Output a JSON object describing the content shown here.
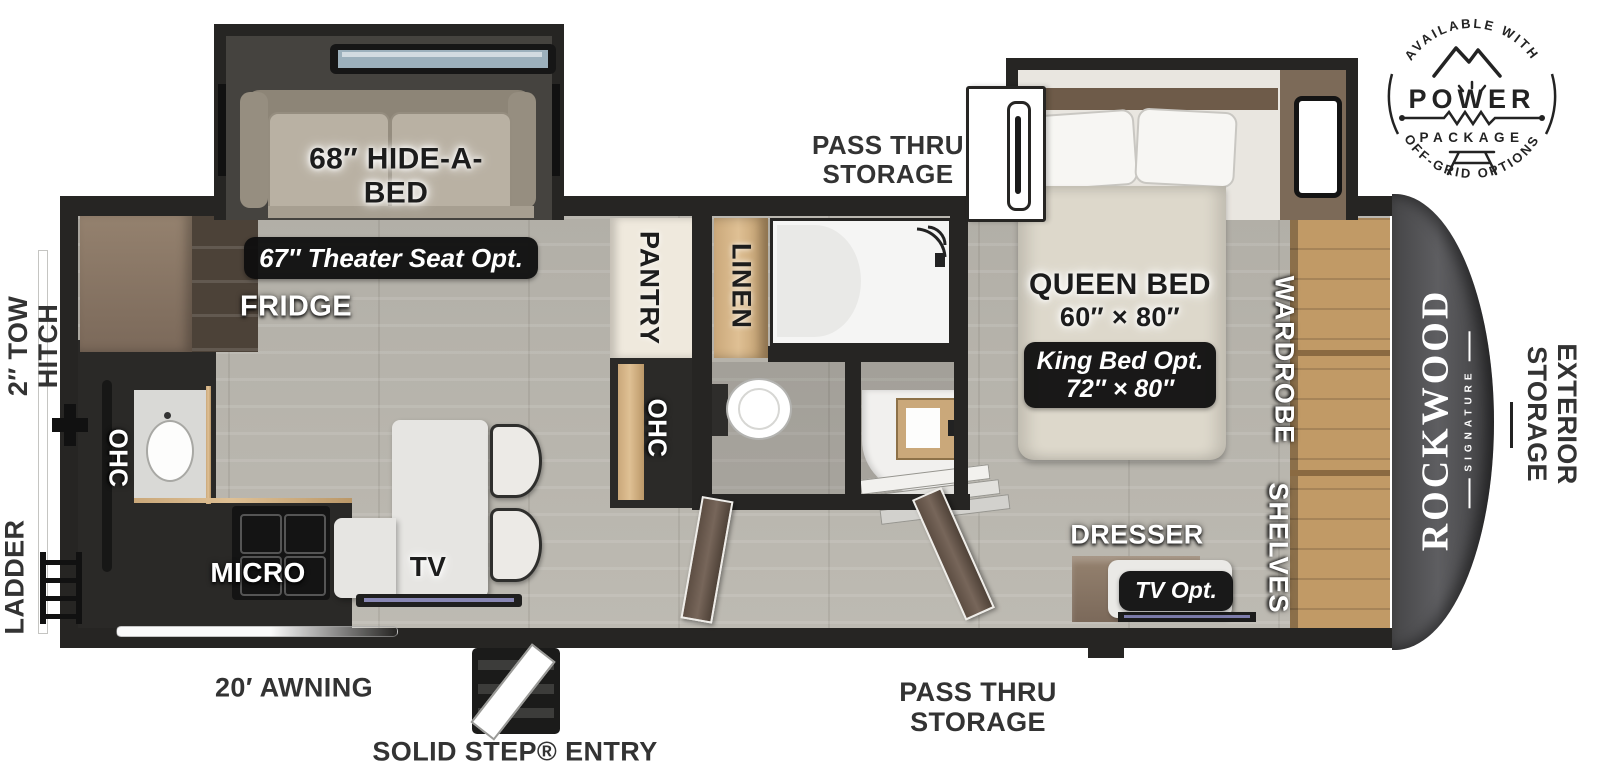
{
  "badge": {
    "arc_top": "AVAILABLE WITH",
    "power": "POWER",
    "package": "PACKAGE",
    "arc_bottom": "OFF-GRID OPTIONS"
  },
  "logo": {
    "brand": "ROCKWOOD",
    "sub": "SIGNATURE"
  },
  "exterior_labels": {
    "pass_thru_top": {
      "line1": "PASS THRU",
      "line2": "STORAGE"
    },
    "pass_thru_bottom": {
      "line1": "PASS THRU",
      "line2": "STORAGE"
    },
    "tow_hitch": {
      "line1": "2″ TOW",
      "line2": "HITCH"
    },
    "ladder": "LADDER",
    "exterior_storage": {
      "line1": "EXTERIOR",
      "line2": "STORAGE"
    },
    "awning": "20′ AWNING",
    "entry": "SOLID STEP® ENTRY"
  },
  "interior_labels": {
    "hide_a_bed": {
      "line1": "68″ HIDE-A-",
      "line2": "BED"
    },
    "theater_seat_option": "67″ Theater Seat Opt.",
    "fridge": "FRIDGE",
    "pantry": "PANTRY",
    "linen": "LINEN",
    "ohc_kitchen": "OHC",
    "ohc_hall": "OHC",
    "micro": "MICRO",
    "tv": "TV",
    "queen_bed": {
      "line1": "QUEEN BED",
      "line2": "60″ × 80″"
    },
    "king_bed_option": {
      "line1": "King Bed Opt.",
      "line2": "72″ × 80″"
    },
    "wardrobe": "WARDROBE",
    "shelves": "SHELVES",
    "dresser": "DRESSER",
    "tv_option": "TV Opt."
  },
  "colors": {
    "wall": "#262523",
    "floor": "#b5b2aa",
    "cap": "#515154",
    "accent_wood": "#caa87a",
    "pill_bg": "#0e0e0e"
  }
}
